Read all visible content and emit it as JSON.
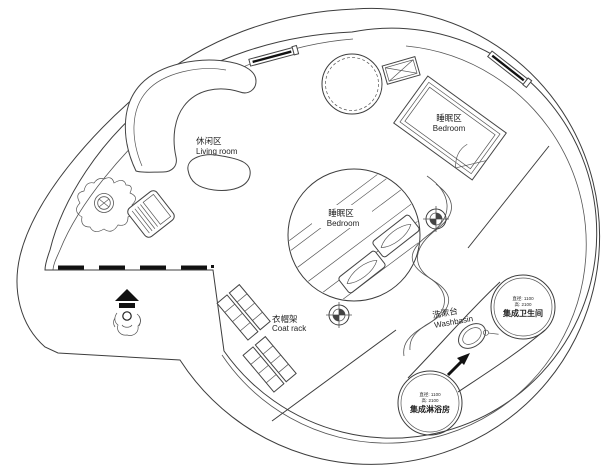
{
  "plan": {
    "colors": {
      "background": "#ffffff",
      "line": "#3d3d3d",
      "hatch": "#c9c9c9",
      "text": "#1f1f1f"
    },
    "areas": {
      "living_room": {
        "zh": "休闲区",
        "en": "Living room"
      },
      "bedroom_upper": {
        "zh": "睡眠区",
        "en": "Bedroom"
      },
      "bedroom_center": {
        "zh": "睡眠区",
        "en": "Bedroom"
      },
      "coat_rack": {
        "zh": "衣帽架",
        "en": "Coat rack"
      },
      "washbasin": {
        "zh": "洗漱台",
        "en": "Washbasin"
      },
      "bathroom_pod": {
        "spec1": "直径: 1100",
        "spec2": "高: 2100",
        "name": "集成卫生间"
      },
      "shower_pod": {
        "spec1": "直径: 1100",
        "spec2": "高: 2100",
        "name": "集成淋浴房"
      }
    }
  }
}
